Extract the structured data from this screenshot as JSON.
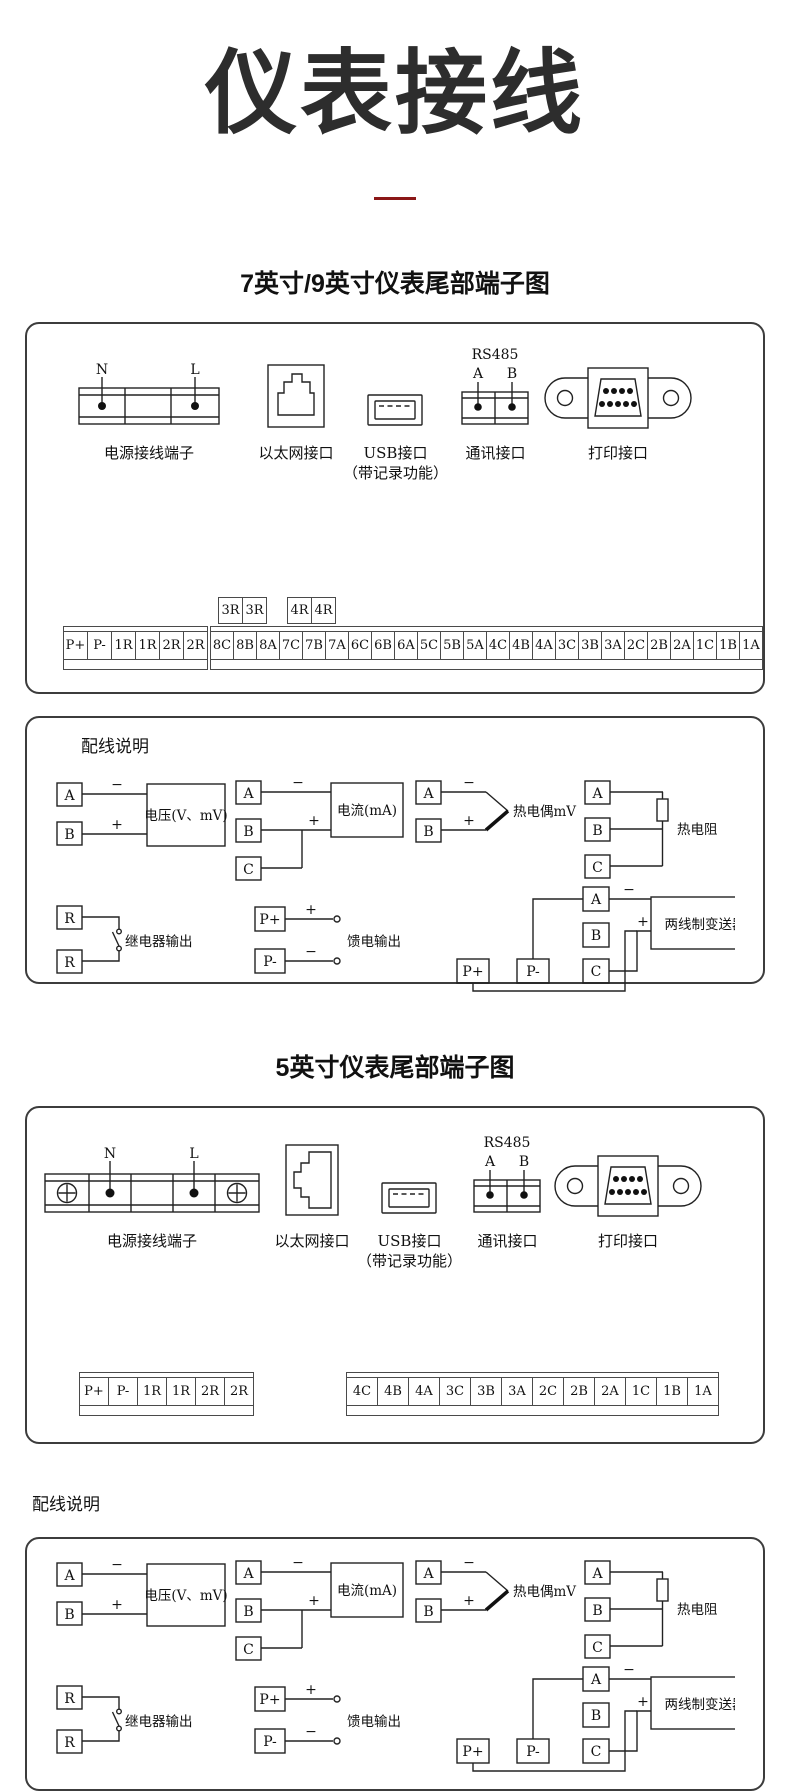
{
  "page": {
    "title": "仪表接线"
  },
  "sections": {
    "seven": {
      "heading": "7英寸/9英寸仪表尾部端子图"
    },
    "five": {
      "heading": "5英寸仪表尾部端子图"
    }
  },
  "connectors": {
    "power": {
      "caption": "电源接线端子",
      "pin_n": "N",
      "pin_l": "L"
    },
    "ethernet": {
      "caption": "以太网接口"
    },
    "usb": {
      "caption": "USB接口",
      "caption2": "（带记录功能）"
    },
    "comm": {
      "caption": "通讯接口",
      "bus": "RS485",
      "pin_a": "A",
      "pin_b": "B"
    },
    "printer": {
      "caption": "打印接口"
    }
  },
  "terminals_seven": {
    "relay_pair_1": [
      "3R",
      "3R"
    ],
    "relay_pair_2": [
      "4R",
      "4R"
    ],
    "left": [
      "P+",
      "P-",
      "1R",
      "1R",
      "2R",
      "2R"
    ],
    "right": [
      "8C",
      "8B",
      "8A",
      "7C",
      "7B",
      "7A",
      "6C",
      "6B",
      "6A",
      "5C",
      "5B",
      "5A",
      "4C",
      "4B",
      "4A",
      "3C",
      "3B",
      "3A",
      "2C",
      "2B",
      "2A",
      "1C",
      "1B",
      "1A"
    ]
  },
  "terminals_five": {
    "left": [
      "P+",
      "P-",
      "1R",
      "1R",
      "2R",
      "2R"
    ],
    "right": [
      "4C",
      "4B",
      "4A",
      "3C",
      "3B",
      "3A",
      "2C",
      "2B",
      "2A",
      "1C",
      "1B",
      "1A"
    ]
  },
  "wiring": {
    "heading": "配线说明",
    "plus": "+",
    "minus": "−",
    "voltage": {
      "label": "电压(V、mV)",
      "t1": "A",
      "t2": "B"
    },
    "current": {
      "label": "电流(mA)",
      "t1": "A",
      "t2": "B",
      "t3": "C"
    },
    "thermocouple": {
      "label": "热电偶mV",
      "t1": "A",
      "t2": "B"
    },
    "rtd": {
      "label": "热电阻",
      "t1": "A",
      "t2": "B",
      "t3": "C"
    },
    "relay": {
      "label": "继电器输出",
      "t1": "R",
      "t2": "R"
    },
    "feed": {
      "label": "馈电输出",
      "t1": "P+",
      "t2": "P-"
    },
    "transmitter": {
      "label": "两线制变送器",
      "t1": "A",
      "t2": "B",
      "t3": "C",
      "p_plus": "P+",
      "p_minus": "P-"
    }
  },
  "colors": {
    "accent": "#8b1717",
    "ink": "#1a1a1a",
    "panel_border": "#3c3c3c"
  }
}
